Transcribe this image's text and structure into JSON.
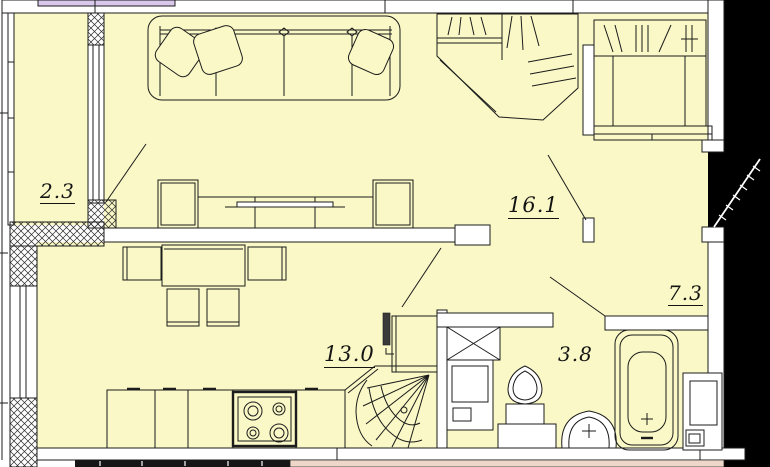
{
  "plan": {
    "type": "apartment-floor-plan",
    "rooms": {
      "balcony": {
        "name": "balcony",
        "area": "2.3",
        "underlined": true
      },
      "living_room": {
        "name": "living-room",
        "area": "16.1",
        "underlined": true
      },
      "hallway": {
        "name": "hallway",
        "area": "7.3",
        "underlined": true
      },
      "kitchen": {
        "name": "kitchen",
        "area": "13.0",
        "underlined": true
      },
      "bathroom": {
        "name": "bathroom",
        "area": "3.8",
        "underlined": false
      }
    },
    "colors": {
      "room_fill": "#f9f8c6",
      "wall_fill": "#ffffff",
      "line": "#1c1c1c",
      "outside": "#000000",
      "glazing_strip": "#d9c8ec",
      "neighbor_strip": "#eed7c9",
      "hatch_line": "#2a2a2a"
    },
    "fixtures": [
      "sofa",
      "tv-stand",
      "corner-wardrobe",
      "hall-wardrobe",
      "entrance-door",
      "dining-table",
      "dining-chairs",
      "kitchen-counter",
      "stove",
      "corner-sink",
      "tall-cabinet",
      "pipe-riser",
      "vent-shaft",
      "washing-machine",
      "toilet",
      "wash-basin",
      "bathtub",
      "utility-shaft",
      "balcony-door",
      "kitchen-door",
      "bathroom-door",
      "hall-door"
    ]
  }
}
